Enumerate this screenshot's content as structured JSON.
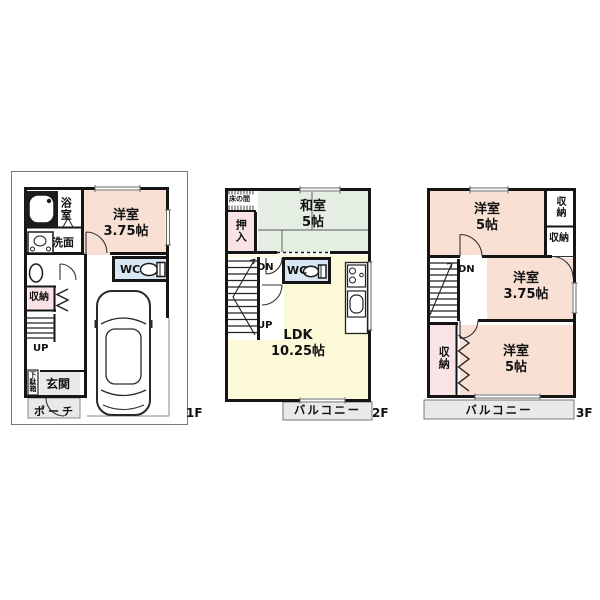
{
  "floors": [
    {
      "label": "1F",
      "rooms": {
        "bath": {
          "label": "浴室"
        },
        "washroom": {
          "label": "洗面"
        },
        "bedroom": {
          "label": "洋室",
          "size": "3.75帖"
        },
        "wc": {
          "label": "WC"
        },
        "closet": {
          "label": "収納"
        },
        "stairs": {
          "label": "UP"
        },
        "shoebox": {
          "label": "下駄箱"
        },
        "entrance": {
          "label": "玄関"
        },
        "porch": {
          "label": "ポーチ"
        }
      }
    },
    {
      "label": "2F",
      "rooms": {
        "tokonoma": {
          "label": "床の間"
        },
        "oshiire": {
          "label": "押入"
        },
        "washitsu": {
          "label": "和室",
          "size": "5帖"
        },
        "stairs_dn": {
          "label": "DN"
        },
        "stairs_up": {
          "label": "UP"
        },
        "wc": {
          "label": "WC"
        },
        "ldk": {
          "label": "LDK",
          "size": "10.25帖"
        },
        "balcony": {
          "label": "バルコニー"
        }
      }
    },
    {
      "label": "3F",
      "rooms": {
        "bedroom_north": {
          "label": "洋室",
          "size": "5帖"
        },
        "closet_ne": {
          "label": "収納"
        },
        "closet_east": {
          "label": "収納"
        },
        "bedroom_center": {
          "label": "洋室",
          "size": "3.75帖"
        },
        "stairs_dn": {
          "label": "DN"
        },
        "closet_west": {
          "label": "収納"
        },
        "bedroom_south": {
          "label": "洋室",
          "size": "5帖"
        },
        "balcony": {
          "label": "バルコニー"
        }
      }
    }
  ],
  "colors": {
    "wall": "#151515",
    "western_room": "#f8e0d4",
    "tatami_room": "#e4eee2",
    "ldk": "#fcf9d8",
    "wc": "#d9e6f4",
    "closet": "#fae3e5",
    "grey_area": "#e9e9e9"
  }
}
